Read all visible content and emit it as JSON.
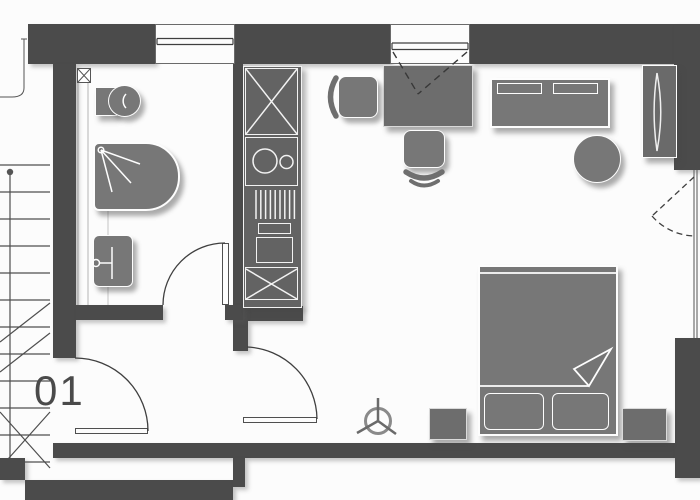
{
  "plan": {
    "unit_label": "01",
    "colors": {
      "background": "#fcfcfc",
      "wall": "#4b4b4b",
      "furniture": "#777777",
      "kitchen": "#636363",
      "outline": "#fdfdfd",
      "linework": "#4f4f4f"
    },
    "symbols": [
      "stairs",
      "stair-walk-line",
      "entry-door-swing",
      "hall-door-swing",
      "bathroom-door-swing",
      "dashed-door-swing",
      "window",
      "window-opening-dashes",
      "installation-shaft",
      "toilet",
      "shower",
      "washbasin",
      "tall-cabinet",
      "kitchen-sink",
      "vent-grille",
      "cooktop",
      "oven",
      "desk",
      "office-chair",
      "sofa",
      "round-table",
      "wardrobe",
      "double-bed",
      "blanket-fold",
      "pillow",
      "nightstand",
      "ceiling-fan"
    ]
  }
}
